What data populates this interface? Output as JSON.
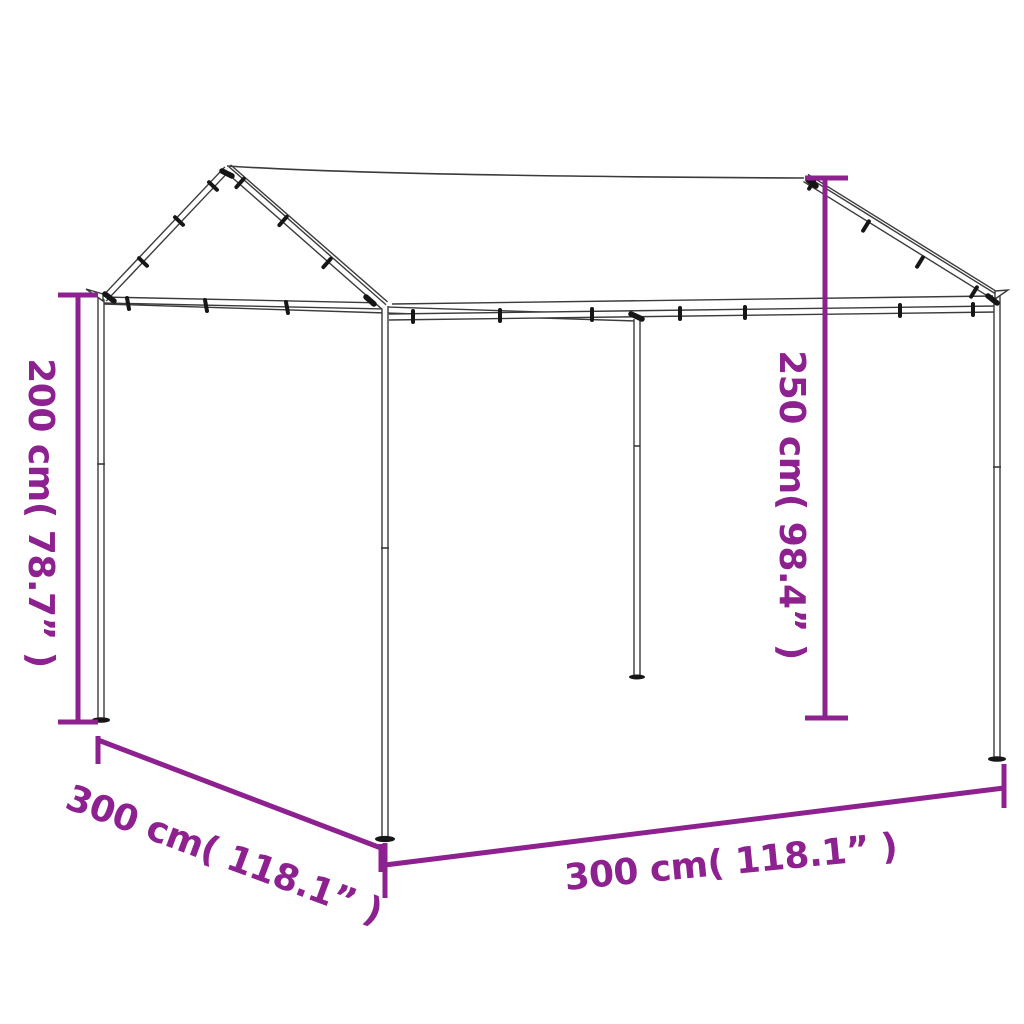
{
  "diagram": {
    "type": "product-dimension-diagram",
    "subject": "canopy tent with steel frame and fabric roof",
    "colors": {
      "background": "#ffffff",
      "accent": "#8e2190",
      "frame_line": "#3b3b3b",
      "clamp": "#161616"
    },
    "labels": {
      "left_height": "200 cm( 78.7” )",
      "right_height": "250 cm( 98.4” )",
      "bottom_left_depth": "300 cm( 118.1” )",
      "bottom_width": "300 cm( 118.1” )"
    }
  }
}
